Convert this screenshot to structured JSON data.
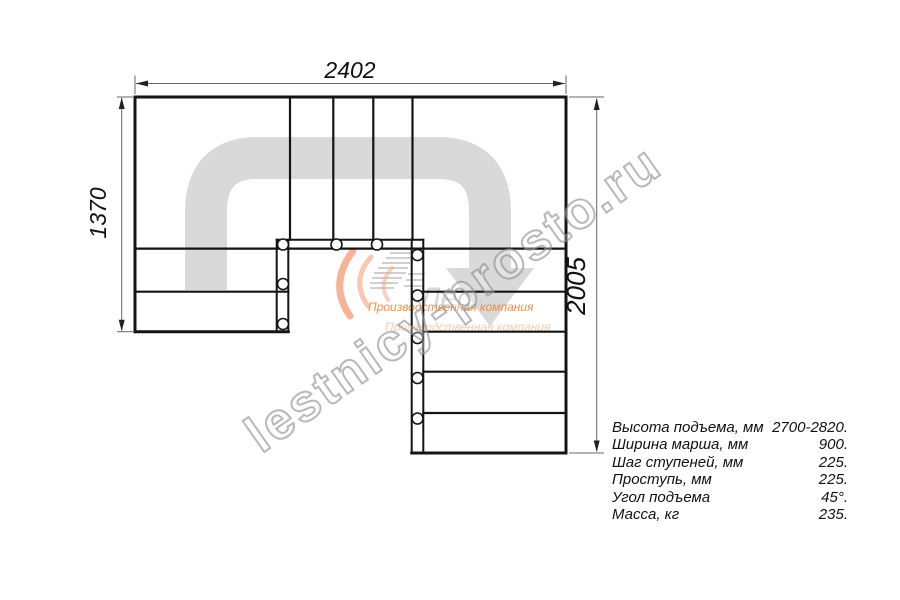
{
  "drawing": {
    "dim_top": "2402",
    "dim_left": "1370",
    "dim_right": "2005"
  },
  "specs": [
    {
      "label": "Высота подъема, мм",
      "value": "2700-2820."
    },
    {
      "label": "Ширина марша, мм",
      "value": "900."
    },
    {
      "label": "Шаг ступеней, мм",
      "value": "225."
    },
    {
      "label": "Проступь, мм",
      "value": "225."
    },
    {
      "label": "Угол подъема",
      "value": "45°."
    },
    {
      "label": "Масса, кг",
      "value": "235."
    }
  ],
  "watermark": "lestnicy-prosto.ru",
  "logo": {
    "wordmark": "Лес",
    "tagline": "Производственная компания"
  },
  "colors": {
    "line": "#141414",
    "walkline": "#d9d9d9",
    "dimension": "#666666",
    "accent_orange": "#e87f2f",
    "watermark_gray": "#888888"
  }
}
